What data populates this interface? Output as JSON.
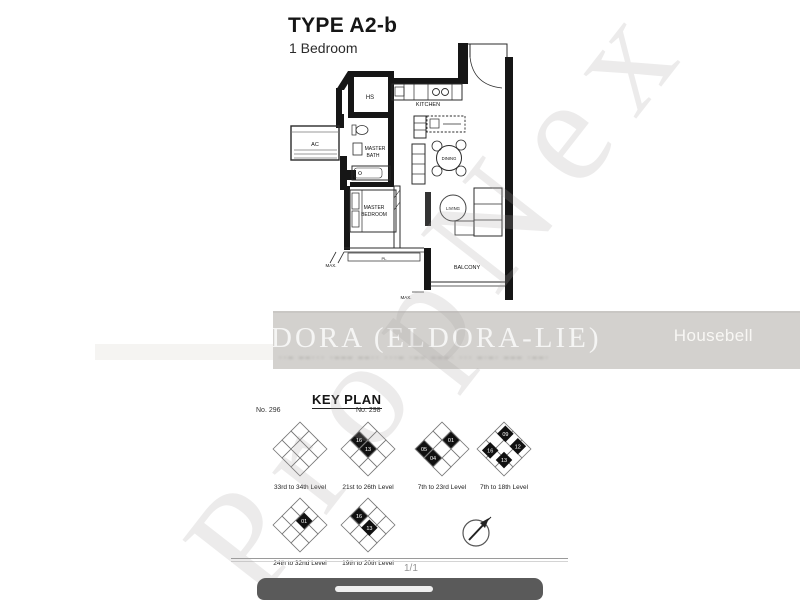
{
  "page": {
    "title": "TYPE A2-b",
    "subtitle": "1 Bedroom"
  },
  "floorplan": {
    "rooms": {
      "hs": "HS",
      "kitchen": "KITCHEN",
      "ac": "AC",
      "master_bath_line1": "MASTER",
      "master_bath_line2": "BATH",
      "dining": "DINING",
      "master_bedroom_line1": "MASTER",
      "master_bedroom_line2": "BEDROOM",
      "living": "LIVING",
      "balcony": "BALCONY"
    },
    "annotations": {
      "max": "MAX.",
      "pl": "PL"
    }
  },
  "watermarks": {
    "band_text": "DORA (ELDORA-LIE)",
    "brand": "Housebell",
    "diagonal": "PropNex",
    "blurred_line": "··– ––··· ·––– ––·· ···– ·–– –––· ··· –·–· ––– ·––·"
  },
  "keyplan": {
    "heading": "KEY PLAN",
    "block_left": "No. 296",
    "block_right": "No. 298",
    "diagrams": [
      {
        "label": "33rd to 34th Level",
        "filled": []
      },
      {
        "label": "21st to 26th Level",
        "filled": [
          {
            "n": "16",
            "x": -13,
            "y": -13
          },
          {
            "n": "13",
            "x": 0,
            "y": 0
          }
        ]
      },
      {
        "label": "7th to 23rd Level",
        "filled": [
          {
            "n": "05",
            "x": -26,
            "y": 0
          },
          {
            "n": "01",
            "x": 13,
            "y": -13
          },
          {
            "n": "04",
            "x": -13,
            "y": 13
          }
        ]
      },
      {
        "label": "7th to 18th Level",
        "filled": [
          {
            "n": "09",
            "x": 2,
            "y": -22
          },
          {
            "n": "16",
            "x": -20,
            "y": 2
          },
          {
            "n": "12",
            "x": 20,
            "y": -4
          },
          {
            "n": "13",
            "x": 0,
            "y": 16
          }
        ]
      },
      {
        "label": "24th to 32nd Level",
        "filled": [
          {
            "n": "01",
            "x": 6,
            "y": -6
          }
        ]
      },
      {
        "label": "19th to 20th Level",
        "filled": [
          {
            "n": "16",
            "x": -13,
            "y": -13
          },
          {
            "n": "13",
            "x": 2,
            "y": 4
          }
        ]
      }
    ],
    "page_indicator": "1/1"
  },
  "colors": {
    "band": "#d3d1ce",
    "bottom_bar": "#5a5a5a",
    "wall": "#161616"
  }
}
